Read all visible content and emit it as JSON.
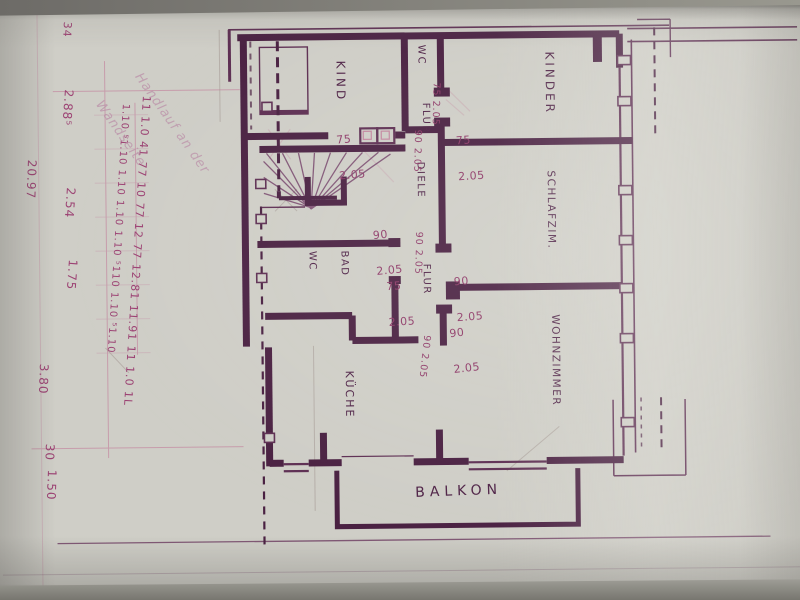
{
  "margin": {
    "tick": "34",
    "date": "20.97",
    "note_line1": "Handlauf an der",
    "note_line2": "Wandseite",
    "dim_chain_main": "11 1.0 41 77 10 77 12 77 12.81 11.91 11 1.0 1L",
    "dim_chain_sub": "1.10 ⁵1.10 1.10 1.10 1.10 ⁵110 1.10 ⁵1.10",
    "dims_left": [
      "2.88⁵",
      "2.54",
      "1.75"
    ],
    "dims_bottom": [
      "3.80",
      "30",
      "1.50"
    ]
  },
  "plan": {
    "rooms": {
      "kind": "KIND",
      "kinder": "KINDER",
      "schlafzimmer": "SCHLAFZIM.",
      "wohnzimmer": "WOHNZIMMER",
      "kueche": "KÜCHE",
      "bad_line1": "BAD",
      "bad_line2": "WC",
      "wc": "WC",
      "flur_top": "FLUR",
      "flur_bottom": "FLUR",
      "diele": "DIELE",
      "balkon": "BALKON"
    },
    "door_dims": {
      "kind_door": {
        "w": "75",
        "h": "2.05"
      },
      "wc_door": "75 2.05",
      "diele_top": "90 2.05",
      "bad_entry": {
        "w": "90",
        "h": "2.05"
      },
      "flur_mid": "90 2.05",
      "bad_door": {
        "w": "75",
        "h": "2.05"
      },
      "kueche_door": "90 2.05",
      "kinder_door": {
        "w": "75",
        "h": "2.05"
      },
      "schlaf_door": {
        "w": "90",
        "h": "2.05"
      },
      "wohn_door": {
        "w": "90",
        "h": "2.05"
      }
    },
    "colors": {
      "ink": "#4a2142",
      "pink": "#c387a0",
      "paper": "#cfcec7"
    }
  }
}
